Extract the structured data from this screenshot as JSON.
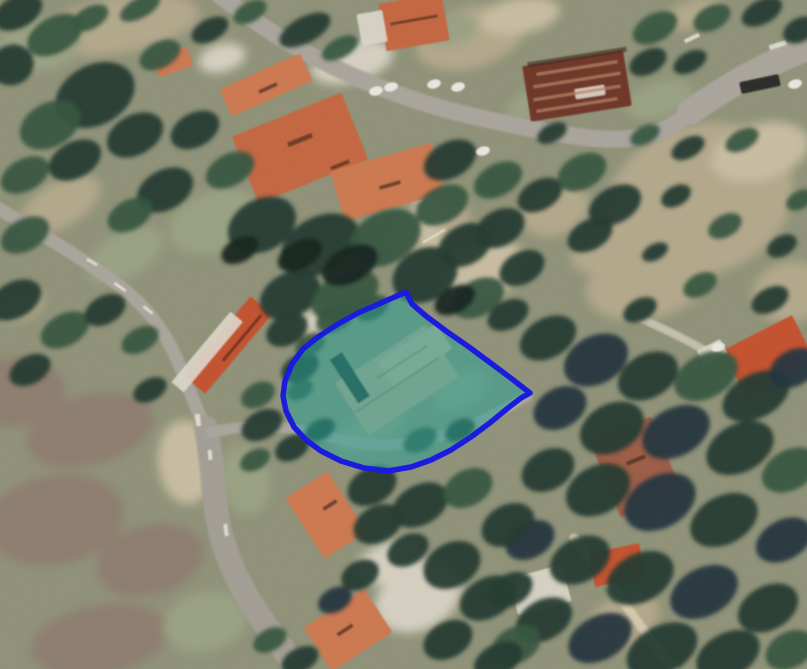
{
  "canvas": {
    "width": 807,
    "height": 669
  },
  "palette": {
    "base": "#8f9278",
    "tree_shades": [
      "#16251f",
      "#243a2f",
      "#35543f",
      "#44684c",
      "#24323c"
    ],
    "scrub_shades": [
      "#b3a88b",
      "#c8bda1",
      "#9aa183",
      "#d6d0c1",
      "#8d7d6e"
    ],
    "road": "#aaa59c",
    "road_dark": "#a39e95",
    "road_light": "#c5bfae",
    "road_pale": "#d3c9ad",
    "road_white": "#e9e5db",
    "roof_shades": [
      "#c4663f",
      "#cd7850",
      "#c4512f",
      "#9c5b45",
      "#6e3526",
      "#b86a4e"
    ],
    "white_structure": "#dcd7ca",
    "roof_mark_dark": "rgba(55,28,18,0.6)",
    "streak_light": "#b58266",
    "car_white": "#e8e6df",
    "car_dark": "#2a2a28",
    "parcel_fill": "rgba(32,162,152,0.5)",
    "parcel_stroke": "#1616df",
    "dirt": "#bfa689",
    "dirt_light": "#cbb394",
    "dirt_mark": "#8a7458",
    "dirt_shadow": "#2c3b31"
  },
  "ground_patches": [
    [
      120,
      25,
      80,
      28,
      -10,
      0
    ],
    [
      40,
      45,
      42,
      26,
      -5,
      2
    ],
    [
      470,
      38,
      55,
      30,
      -15,
      0
    ],
    [
      520,
      16,
      40,
      18,
      -10,
      1
    ],
    [
      695,
      14,
      30,
      14,
      -15,
      0
    ],
    [
      545,
      100,
      42,
      16,
      -20,
      2
    ],
    [
      700,
      200,
      95,
      75,
      -20,
      0
    ],
    [
      760,
      152,
      50,
      28,
      -15,
      1
    ],
    [
      650,
      280,
      65,
      38,
      -15,
      0
    ],
    [
      792,
      292,
      40,
      30,
      -10,
      0
    ],
    [
      432,
      226,
      40,
      25,
      -25,
      0
    ],
    [
      482,
      272,
      45,
      28,
      -25,
      1
    ],
    [
      215,
      222,
      48,
      30,
      -20,
      2
    ],
    [
      60,
      205,
      45,
      22,
      -30,
      0
    ],
    [
      125,
      255,
      42,
      22,
      -30,
      2
    ],
    [
      15,
      392,
      50,
      35,
      -5,
      4
    ],
    [
      90,
      430,
      65,
      35,
      -15,
      4
    ],
    [
      55,
      520,
      70,
      45,
      -10,
      4
    ],
    [
      150,
      560,
      55,
      35,
      -15,
      4
    ],
    [
      100,
      640,
      70,
      35,
      -10,
      4
    ],
    [
      205,
      622,
      42,
      30,
      -15,
      2
    ],
    [
      186,
      462,
      28,
      42,
      -5,
      1
    ],
    [
      418,
      598,
      45,
      32,
      -25,
      3
    ],
    [
      390,
      562,
      35,
      20,
      -20,
      3
    ],
    [
      622,
      622,
      40,
      25,
      -30,
      0
    ],
    [
      660,
      100,
      35,
      18,
      -15,
      2
    ],
    [
      312,
      322,
      15,
      11,
      -20,
      3
    ],
    [
      352,
      62,
      42,
      20,
      -15,
      3
    ],
    [
      222,
      58,
      24,
      14,
      -15,
      3
    ],
    [
      450,
      30,
      28,
      16,
      -10,
      2
    ],
    [
      428,
      215,
      14,
      38,
      -8,
      1
    ],
    [
      555,
      210,
      35,
      25,
      -20,
      0
    ],
    [
      600,
      252,
      30,
      20,
      -20,
      0
    ],
    [
      245,
      480,
      25,
      35,
      -10,
      2
    ],
    [
      460,
      390,
      30,
      18,
      -25,
      2
    ],
    [
      370,
      430,
      40,
      16,
      -30,
      2
    ],
    [
      20,
      305,
      25,
      15,
      -20,
      0
    ]
  ],
  "roads": [
    {
      "d": "M 218,-6 C 255,22 285,42 312,56 C 365,84 420,104 472,116 C 525,128 585,141 622,139 C 655,137 672,128 700,106 C 730,82 765,60 812,44",
      "w": 17,
      "c": "road"
    },
    {
      "d": "M 690,112 C 730,84 770,62 812,46",
      "w": 26,
      "c": "road"
    },
    {
      "d": "M -6,206 C 45,236 95,266 126,291 C 152,312 168,338 178,362 C 186,381 196,408 206,430",
      "w": 13,
      "c": "road"
    },
    {
      "d": "M 206,428 C 214,468 212,500 221,535 C 231,573 251,606 272,634 C 281,646 290,658 297,674",
      "w": 24,
      "c": "road_dark"
    },
    {
      "d": "M 212,432 C 252,424 284,425 322,435 C 360,445 392,449 430,439 C 463,431 498,414 527,396",
      "w": 11,
      "c": "road"
    },
    {
      "d": "M 636,316 C 666,330 692,342 714,356",
      "w": 8,
      "c": "road_light"
    },
    {
      "d": "M 574,538 C 598,568 622,600 648,636 C 658,650 668,662 676,674",
      "w": 9,
      "c": "road_pale"
    }
  ],
  "road_marks": [
    [
      120,
      287,
      14,
      3,
      35
    ],
    [
      148,
      310,
      12,
      3,
      38
    ],
    [
      92,
      262,
      12,
      3,
      30
    ],
    [
      198,
      420,
      5,
      12,
      -8
    ],
    [
      692,
      38,
      16,
      4,
      -25
    ],
    [
      778,
      45,
      18,
      5,
      -18
    ],
    [
      210,
      455,
      4,
      10,
      -5
    ],
    [
      226,
      530,
      4,
      12,
      -8
    ],
    [
      430,
      196,
      26,
      2,
      -30
    ],
    [
      432,
      216,
      26,
      2,
      -30
    ],
    [
      434,
      236,
      26,
      2,
      -30
    ]
  ],
  "buildings": [
    [
      414,
      22,
      64,
      48,
      -10,
      0
    ],
    [
      266,
      85,
      88,
      30,
      -24,
      1
    ],
    [
      300,
      148,
      118,
      72,
      -22,
      0
    ],
    [
      388,
      182,
      105,
      52,
      -16,
      1
    ],
    [
      577,
      86,
      102,
      56,
      -9,
      4
    ],
    [
      228,
      345,
      104,
      28,
      -50,
      2
    ],
    [
      326,
      515,
      50,
      72,
      -33,
      1
    ],
    [
      348,
      630,
      72,
      52,
      -33,
      1
    ],
    [
      617,
      565,
      52,
      34,
      -12,
      2
    ],
    [
      769,
      356,
      78,
      52,
      -27,
      2
    ],
    [
      636,
      467,
      66,
      82,
      -22,
      3
    ],
    [
      173,
      62,
      36,
      20,
      -20,
      1
    ]
  ],
  "white_areas": [
    [
      372,
      28,
      26,
      32,
      -10
    ],
    [
      207,
      352,
      92,
      16,
      -50
    ],
    [
      540,
      590,
      55,
      38,
      -15
    ],
    [
      712,
      352,
      26,
      16,
      -27
    ],
    [
      590,
      92,
      30,
      10,
      -9
    ]
  ],
  "roof_marks": [
    [
      300,
      140,
      26,
      5,
      -22
    ],
    [
      340,
      165,
      20,
      4,
      -22
    ],
    [
      390,
      185,
      22,
      4,
      -16
    ],
    [
      268,
      88,
      20,
      4,
      -24
    ],
    [
      330,
      505,
      16,
      4,
      -33
    ],
    [
      345,
      630,
      18,
      4,
      -33
    ],
    [
      242,
      338,
      60,
      3,
      -50
    ],
    [
      414,
      20,
      48,
      3,
      -10
    ],
    [
      636,
      460,
      20,
      4,
      -22
    ],
    [
      577,
      57,
      100,
      5,
      -9
    ]
  ],
  "light_streaks": [
    [
      577,
      68,
      82,
      3,
      -9
    ],
    [
      577,
      80,
      88,
      3,
      -9
    ],
    [
      577,
      93,
      88,
      3,
      -9
    ],
    [
      577,
      105,
      82,
      3,
      -9
    ]
  ],
  "trees": [
    [
      18,
      12,
      26,
      16,
      1
    ],
    [
      55,
      35,
      30,
      18,
      2
    ],
    [
      12,
      65,
      22,
      20,
      1
    ],
    [
      90,
      18,
      20,
      11,
      2
    ],
    [
      140,
      8,
      22,
      10,
      2
    ],
    [
      95,
      95,
      42,
      30,
      1
    ],
    [
      50,
      125,
      32,
      22,
      2
    ],
    [
      135,
      135,
      30,
      20,
      1
    ],
    [
      25,
      175,
      26,
      16,
      2
    ],
    [
      75,
      160,
      28,
      18,
      1
    ],
    [
      160,
      55,
      22,
      13,
      2
    ],
    [
      210,
      30,
      20,
      11,
      1
    ],
    [
      250,
      12,
      18,
      10,
      2
    ],
    [
      195,
      130,
      26,
      17,
      1
    ],
    [
      165,
      190,
      30,
      20,
      1
    ],
    [
      130,
      215,
      24,
      15,
      2
    ],
    [
      305,
      30,
      28,
      13,
      1
    ],
    [
      340,
      48,
      20,
      10,
      2
    ],
    [
      25,
      235,
      26,
      16,
      2
    ],
    [
      15,
      300,
      28,
      18,
      1
    ],
    [
      65,
      330,
      26,
      16,
      2
    ],
    [
      30,
      370,
      22,
      14,
      1
    ],
    [
      105,
      310,
      22,
      14,
      1
    ],
    [
      140,
      340,
      20,
      12,
      2
    ],
    [
      150,
      390,
      18,
      11,
      1
    ],
    [
      287,
      330,
      22,
      15,
      1
    ],
    [
      300,
      368,
      20,
      13,
      1
    ],
    [
      258,
      395,
      18,
      12,
      2
    ],
    [
      230,
      170,
      26,
      16,
      2
    ],
    [
      262,
      225,
      36,
      26,
      1
    ],
    [
      320,
      245,
      42,
      28,
      1
    ],
    [
      385,
      238,
      38,
      26,
      2
    ],
    [
      290,
      295,
      32,
      22,
      1
    ],
    [
      345,
      295,
      36,
      22,
      2
    ],
    [
      425,
      275,
      34,
      26,
      1
    ],
    [
      465,
      245,
      28,
      20,
      1
    ],
    [
      442,
      205,
      28,
      18,
      2
    ],
    [
      500,
      228,
      26,
      18,
      1
    ],
    [
      522,
      268,
      24,
      16,
      1
    ],
    [
      478,
      298,
      28,
      18,
      2
    ],
    [
      508,
      315,
      22,
      14,
      1
    ],
    [
      350,
      265,
      30,
      18,
      0
    ],
    [
      300,
      255,
      24,
      14,
      0
    ],
    [
      455,
      300,
      22,
      13,
      0
    ],
    [
      240,
      250,
      20,
      12,
      0
    ],
    [
      335,
      318,
      20,
      13,
      2
    ],
    [
      372,
      308,
      18,
      11,
      2
    ],
    [
      310,
      345,
      16,
      10,
      2
    ],
    [
      300,
      390,
      14,
      9,
      2
    ],
    [
      320,
      430,
      16,
      10,
      1
    ],
    [
      420,
      440,
      18,
      11,
      2
    ],
    [
      460,
      430,
      16,
      10,
      1
    ],
    [
      450,
      160,
      28,
      18,
      1
    ],
    [
      498,
      180,
      26,
      16,
      2
    ],
    [
      540,
      195,
      24,
      15,
      1
    ],
    [
      582,
      172,
      26,
      17,
      2
    ],
    [
      615,
      205,
      28,
      18,
      1
    ],
    [
      590,
      235,
      24,
      15,
      1
    ],
    [
      552,
      133,
      16,
      9,
      1
    ],
    [
      655,
      28,
      24,
      14,
      2
    ],
    [
      648,
      62,
      20,
      12,
      1
    ],
    [
      712,
      18,
      20,
      12,
      2
    ],
    [
      762,
      12,
      22,
      12,
      1
    ],
    [
      800,
      30,
      18,
      12,
      1
    ],
    [
      690,
      62,
      18,
      10,
      1
    ],
    [
      645,
      135,
      16,
      9,
      2
    ],
    [
      688,
      148,
      18,
      10,
      1
    ],
    [
      742,
      140,
      18,
      10,
      2
    ],
    [
      676,
      196,
      16,
      10,
      1
    ],
    [
      725,
      226,
      18,
      11,
      2
    ],
    [
      782,
      246,
      16,
      10,
      1
    ],
    [
      655,
      252,
      14,
      8,
      1
    ],
    [
      700,
      285,
      18,
      11,
      2
    ],
    [
      770,
      300,
      20,
      12,
      1
    ],
    [
      800,
      200,
      15,
      9,
      2
    ],
    [
      640,
      310,
      18,
      11,
      1
    ],
    [
      548,
      338,
      30,
      20,
      1
    ],
    [
      596,
      360,
      34,
      24,
      4
    ],
    [
      648,
      376,
      32,
      22,
      1
    ],
    [
      706,
      376,
      34,
      22,
      2
    ],
    [
      756,
      396,
      36,
      22,
      1
    ],
    [
      794,
      368,
      26,
      18,
      4
    ],
    [
      560,
      408,
      28,
      20,
      4
    ],
    [
      612,
      428,
      34,
      24,
      1
    ],
    [
      676,
      432,
      36,
      24,
      4
    ],
    [
      740,
      448,
      36,
      24,
      1
    ],
    [
      790,
      470,
      30,
      20,
      2
    ],
    [
      548,
      470,
      28,
      20,
      1
    ],
    [
      598,
      490,
      34,
      24,
      1
    ],
    [
      660,
      502,
      38,
      26,
      4
    ],
    [
      724,
      520,
      36,
      24,
      1
    ],
    [
      784,
      540,
      30,
      20,
      4
    ],
    [
      530,
      540,
      26,
      18,
      4
    ],
    [
      580,
      560,
      32,
      22,
      1
    ],
    [
      640,
      578,
      36,
      24,
      1
    ],
    [
      704,
      592,
      36,
      24,
      4
    ],
    [
      768,
      608,
      32,
      22,
      1
    ],
    [
      544,
      620,
      30,
      20,
      1
    ],
    [
      600,
      638,
      34,
      22,
      4
    ],
    [
      662,
      650,
      38,
      24,
      1
    ],
    [
      728,
      655,
      34,
      22,
      1
    ],
    [
      790,
      650,
      26,
      18,
      2
    ],
    [
      510,
      590,
      24,
      16,
      1
    ],
    [
      516,
      645,
      26,
      18,
      2
    ],
    [
      262,
      425,
      22,
      14,
      1
    ],
    [
      292,
      448,
      18,
      12,
      1
    ],
    [
      255,
      460,
      16,
      10,
      2
    ],
    [
      372,
      486,
      26,
      18,
      1
    ],
    [
      420,
      505,
      30,
      20,
      1
    ],
    [
      468,
      488,
      26,
      18,
      2
    ],
    [
      508,
      525,
      28,
      20,
      1
    ],
    [
      378,
      524,
      26,
      18,
      1
    ],
    [
      408,
      550,
      22,
      15,
      1
    ],
    [
      452,
      565,
      30,
      22,
      1
    ],
    [
      488,
      598,
      30,
      20,
      1
    ],
    [
      360,
      575,
      20,
      14,
      1
    ],
    [
      335,
      600,
      18,
      12,
      4
    ],
    [
      300,
      660,
      20,
      12,
      1
    ],
    [
      270,
      640,
      18,
      11,
      2
    ],
    [
      448,
      640,
      26,
      18,
      1
    ],
    [
      498,
      660,
      26,
      16,
      1
    ]
  ],
  "cars_white": [
    [
      376,
      91
    ],
    [
      391,
      87
    ],
    [
      434,
      84
    ],
    [
      458,
      87
    ],
    [
      483,
      151
    ],
    [
      795,
      84
    ],
    [
      718,
      347
    ]
  ],
  "cars_dark": [
    [
      760,
      84,
      40,
      12,
      -12
    ]
  ],
  "parcel": {
    "points": [
      [
        406,
        292
      ],
      [
        381,
        303
      ],
      [
        358,
        313
      ],
      [
        338,
        324
      ],
      [
        318,
        337
      ],
      [
        303,
        349
      ],
      [
        292,
        364
      ],
      [
        285,
        381
      ],
      [
        283,
        396
      ],
      [
        286,
        411
      ],
      [
        294,
        427
      ],
      [
        306,
        440
      ],
      [
        321,
        451
      ],
      [
        341,
        461
      ],
      [
        364,
        468
      ],
      [
        388,
        471
      ],
      [
        411,
        467
      ],
      [
        431,
        460
      ],
      [
        451,
        450
      ],
      [
        471,
        437
      ],
      [
        491,
        422
      ],
      [
        508,
        408
      ],
      [
        521,
        398
      ],
      [
        530,
        393
      ],
      [
        512,
        379
      ],
      [
        492,
        364
      ],
      [
        469,
        347
      ],
      [
        446,
        331
      ],
      [
        426,
        316
      ],
      [
        412,
        304
      ]
    ],
    "stroke_width": 5.5,
    "dirt_main": [
      397,
      380,
      108,
      62,
      -33
    ],
    "dirt_top": [
      415,
      355,
      70,
      30,
      -33
    ],
    "dirt_shadow_strip": [
      350,
      378,
      14,
      52,
      -33
    ],
    "dirt_marks": [
      [
        397,
        385,
        100,
        2,
        -33
      ],
      [
        402,
        362,
        60,
        2,
        -33
      ]
    ]
  }
}
